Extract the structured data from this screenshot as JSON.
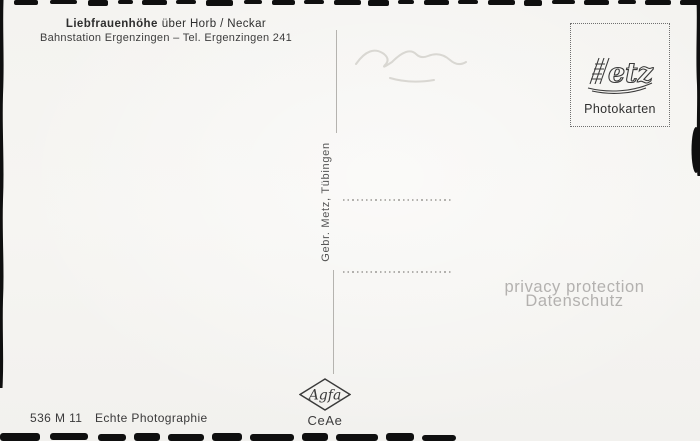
{
  "postcard": {
    "header": {
      "title_bold": "Liebfrauenhöhe",
      "title_rest": "über Horb / Neckar",
      "subtitle": "Bahnstation Ergenzingen – Tel. Ergenzingen 241"
    },
    "stamp_box": {
      "brand": "Metz",
      "label": "Photokarten"
    },
    "spine": {
      "publisher": "Gebr. Metz, Tübingen"
    },
    "watermark": {
      "line1": "privacy protection",
      "line2": "Datenschutz"
    },
    "footer": {
      "order_code": "536 M 11",
      "print_label": "Echte Photographie",
      "film_brand": "Agfa",
      "print_code": "CeAe"
    }
  },
  "colors": {
    "paper": "#f5f4f1",
    "ink": "#3a3a3a",
    "rule": "#b5b3af",
    "watermark": "#b3b1af",
    "scan_artifact": "#0f0f0f"
  }
}
